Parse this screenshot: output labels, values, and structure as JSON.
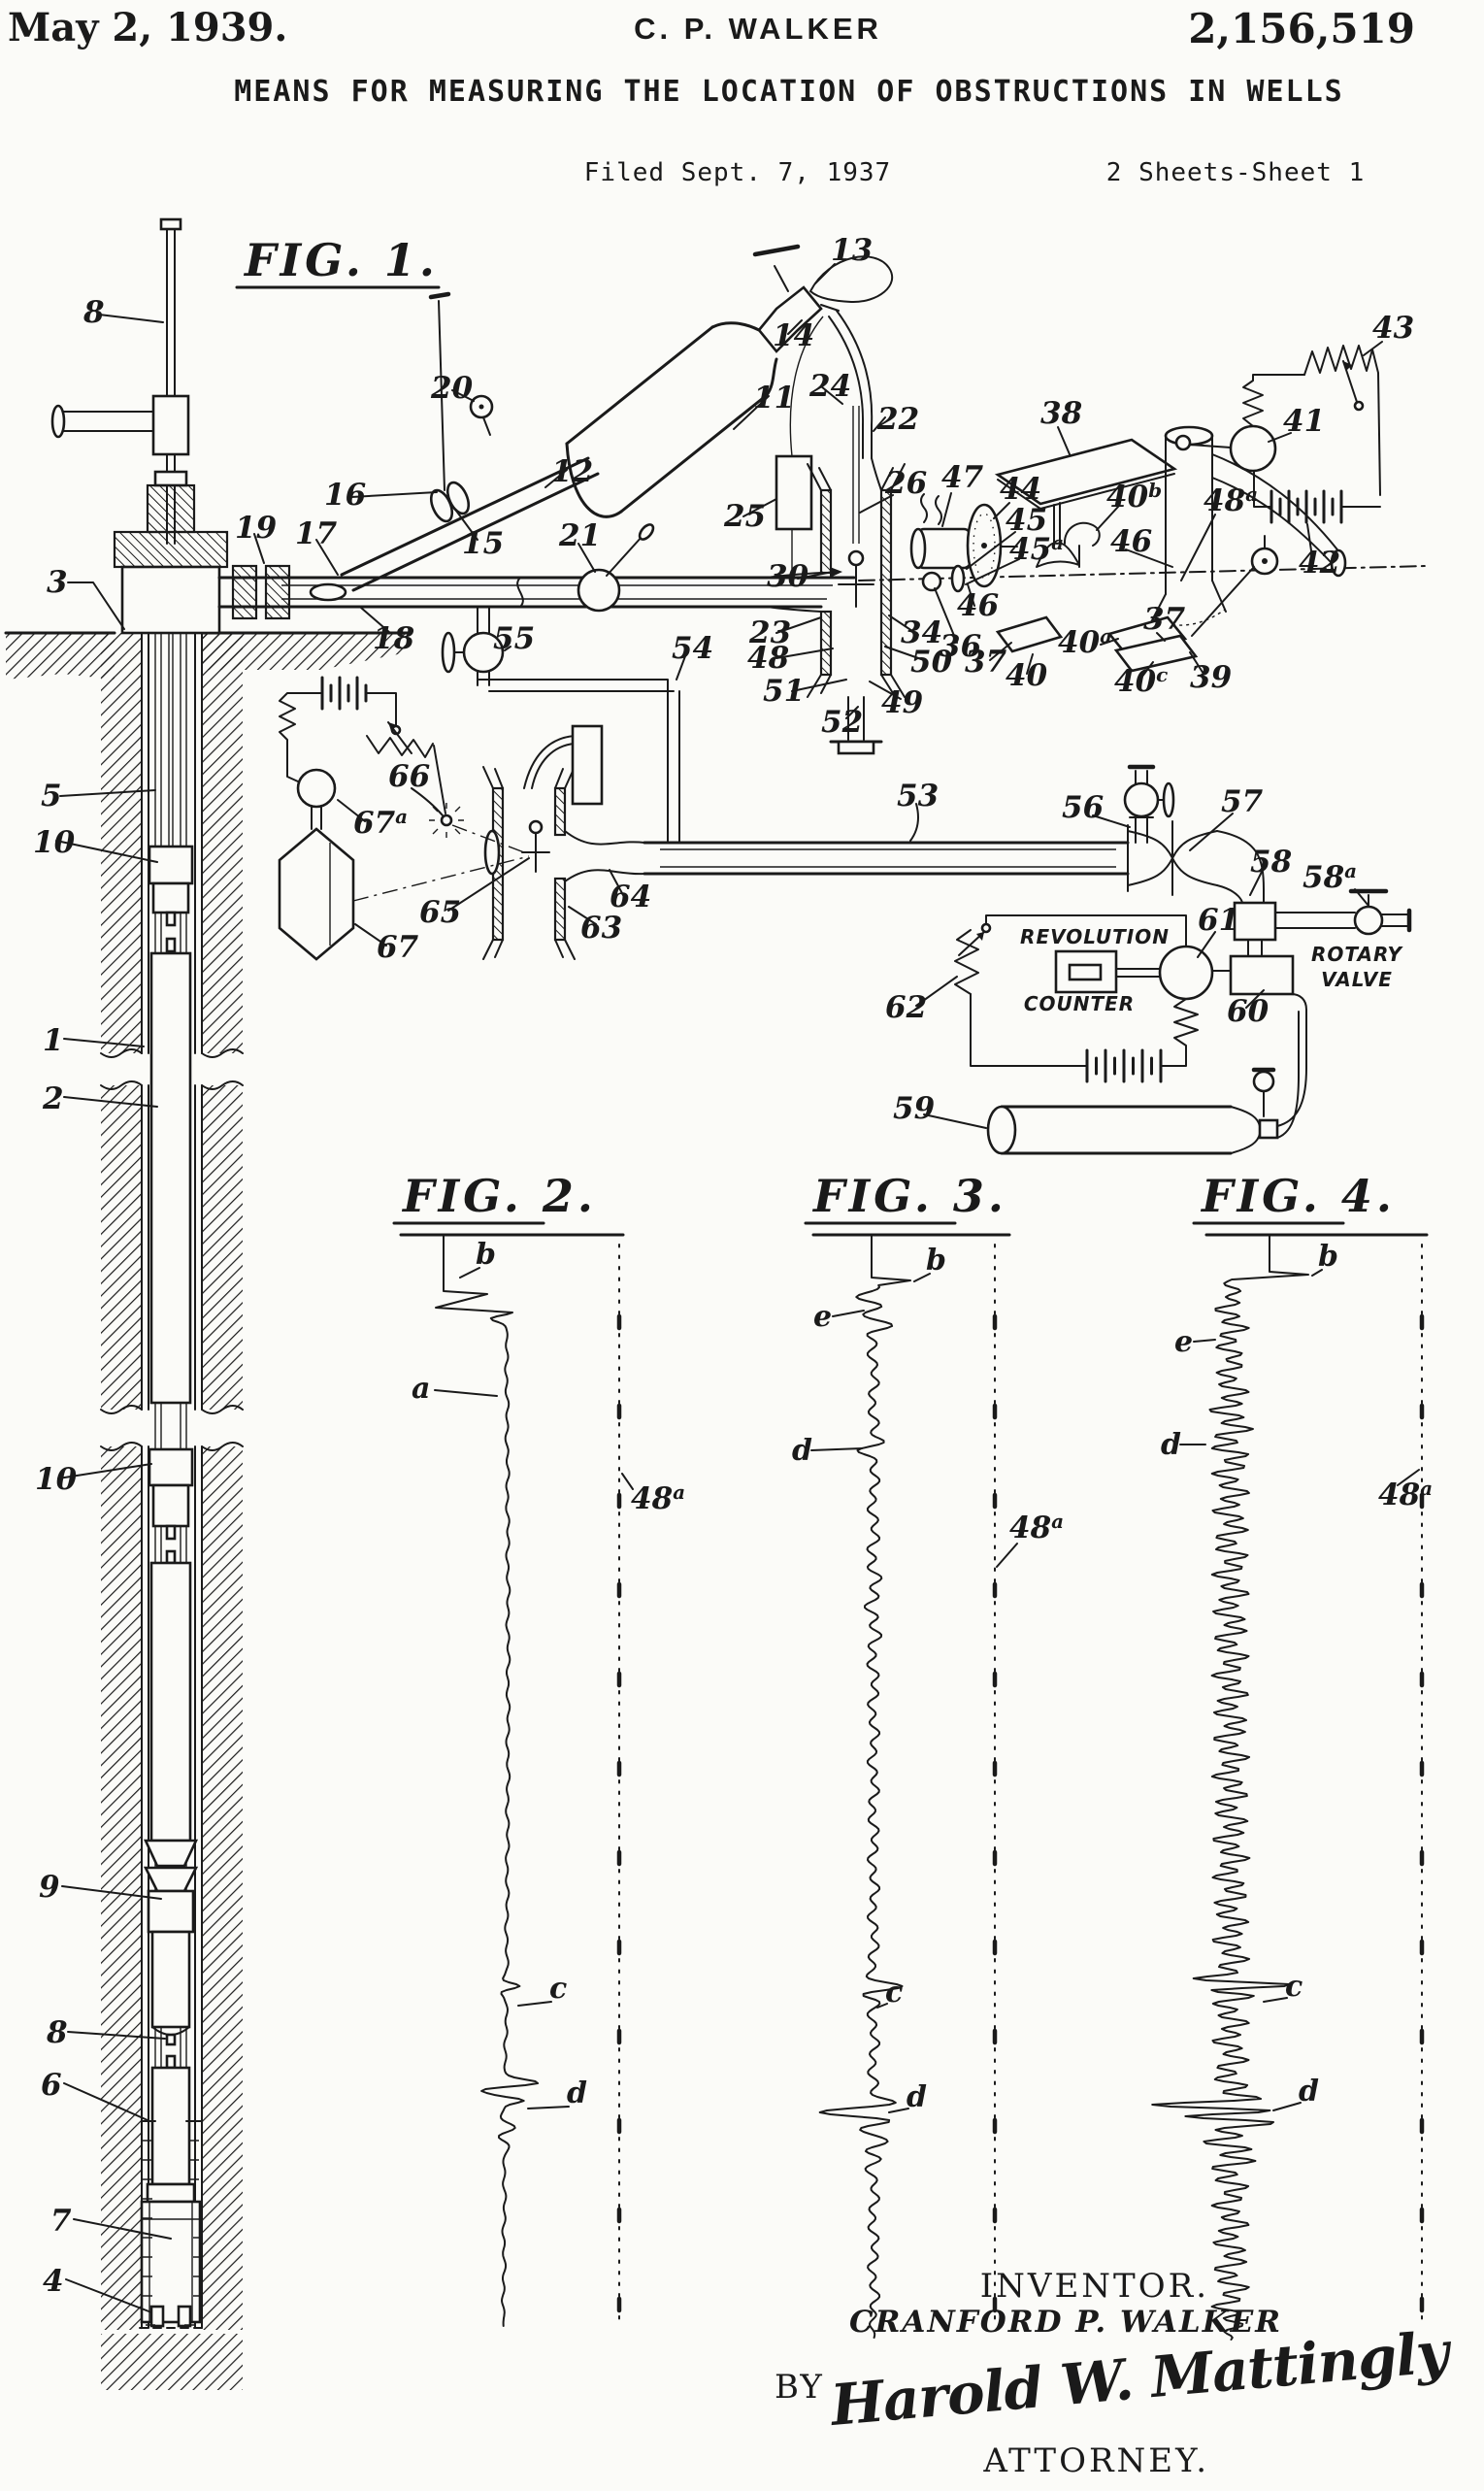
{
  "header": {
    "date": "May 2, 1939.",
    "author": "C. P. WALKER",
    "patent_number": "2,156,519",
    "title": "MEANS FOR MEASURING THE LOCATION OF OBSTRUCTIONS IN WELLS",
    "filed": "Filed Sept. 7, 1937",
    "sheet": "2 Sheets-Sheet 1"
  },
  "fig1": {
    "title": "FIG. 1.",
    "labels": {
      "1": "1",
      "2": "2",
      "3": "3",
      "4": "4",
      "5": "5",
      "6": "6",
      "7": "7",
      "8": "8",
      "9": "9",
      "10": "10",
      "11": "11",
      "12": "12",
      "13": "13",
      "14": "14",
      "15": "15",
      "16": "16",
      "17": "17",
      "18": "18",
      "19": "19",
      "20": "20",
      "21": "21",
      "22": "22",
      "23": "23",
      "24": "24",
      "25": "25",
      "26": "26",
      "30": "30",
      "34": "34",
      "36": "36",
      "37": "37",
      "38": "38",
      "39": "39",
      "40": "40",
      "41": "41",
      "42": "42",
      "43": "43",
      "44": "44",
      "45": "45",
      "46": "46",
      "47": "47",
      "48": "48",
      "49": "49",
      "50": "50",
      "51": "51",
      "52": "52",
      "53": "53",
      "54": "54",
      "55": "55",
      "56": "56",
      "57": "57",
      "58": "58",
      "59": "59",
      "60": "60",
      "61": "61",
      "62": "62",
      "63": "63",
      "64": "64",
      "65": "65",
      "66": "66",
      "67": "67"
    },
    "sup_labels": {
      "40a": {
        "base": "40",
        "sup": "a"
      },
      "40b": {
        "base": "40",
        "sup": "b"
      },
      "40c": {
        "base": "40",
        "sup": "c"
      },
      "45a": {
        "base": "45",
        "sup": "a"
      },
      "48a": {
        "base": "48",
        "sup": "a"
      },
      "58a": {
        "base": "58",
        "sup": "a"
      },
      "67a": {
        "base": "67",
        "sup": "a"
      }
    },
    "annotations": {
      "revolution_line1": "REVOLUTION",
      "revolution_line2": "COUNTER",
      "rotary_line1": "ROTARY",
      "rotary_line2": "VALVE"
    }
  },
  "fig2": {
    "title": "FIG. 2.",
    "labels": {
      "a": "a",
      "b": "b",
      "c": "c",
      "d": "d"
    },
    "track": {
      "base": "48",
      "sup": "a"
    }
  },
  "fig3": {
    "title": "FIG. 3.",
    "labels": {
      "b": "b",
      "c": "c",
      "d": "d",
      "e": "e"
    },
    "track": {
      "base": "48",
      "sup": "a"
    }
  },
  "fig4": {
    "title": "FIG. 4.",
    "labels": {
      "b": "b",
      "c": "c",
      "d": "d",
      "e": "e"
    },
    "track": {
      "base": "48",
      "sup": "a"
    }
  },
  "signature": {
    "inventor_caption": "INVENTOR.",
    "inventor_name": "CRANFORD P. WALKER",
    "by": "BY",
    "signature_name": "Harold W. Mattingly",
    "attorney_caption": "ATTORNEY."
  }
}
